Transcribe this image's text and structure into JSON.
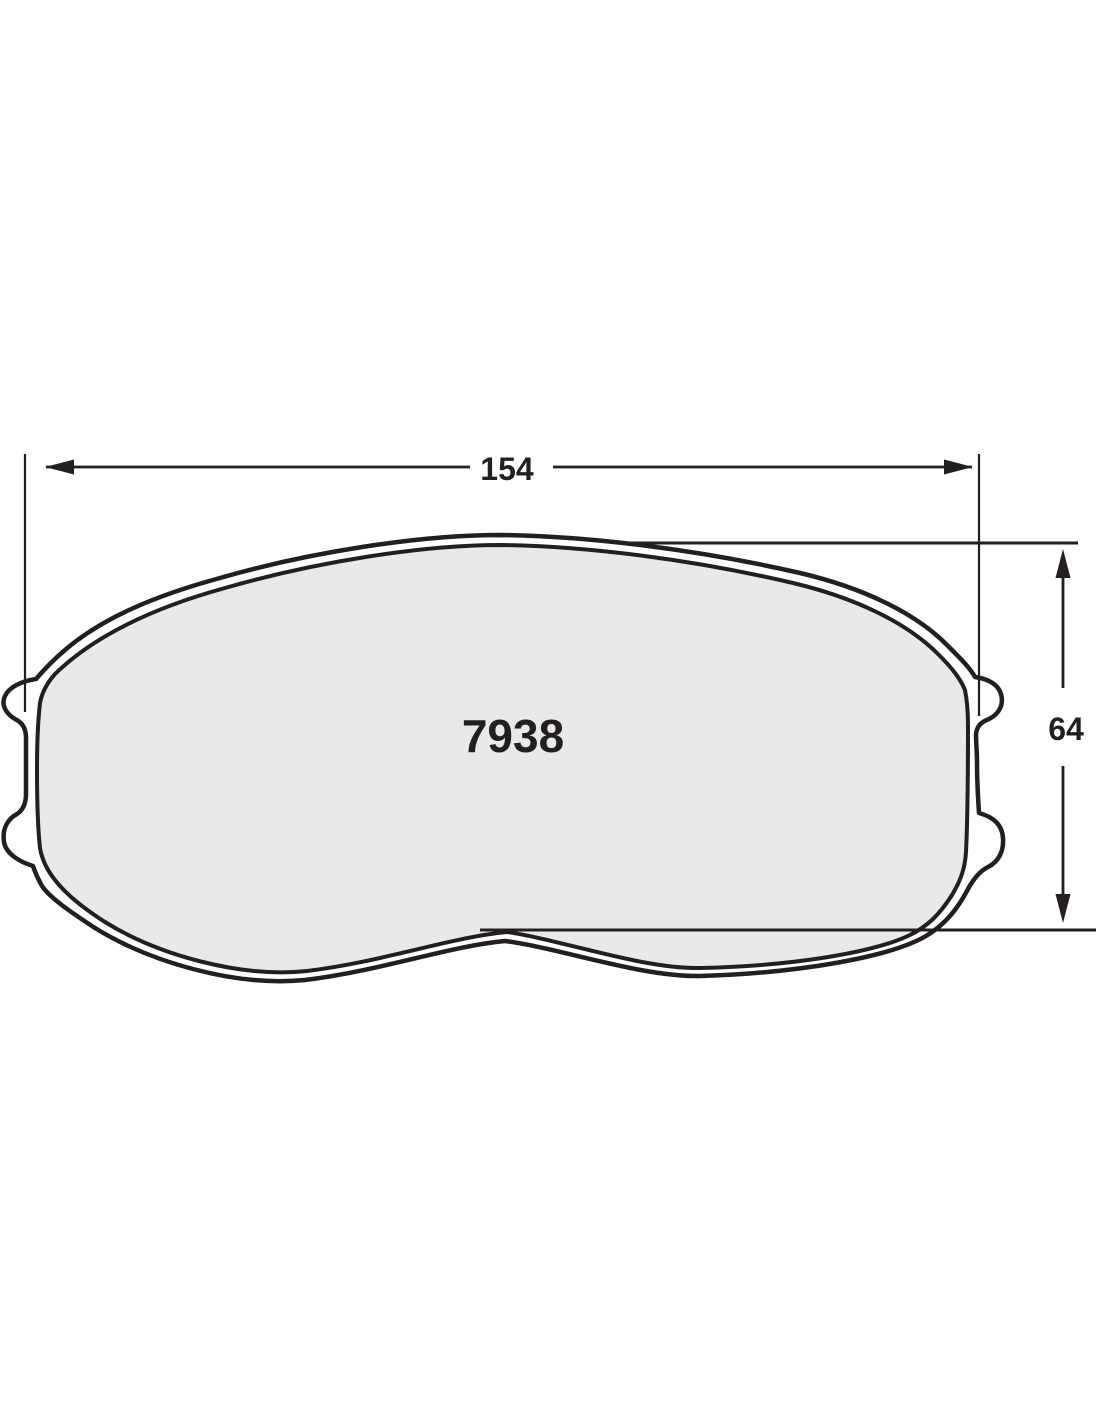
{
  "diagram": {
    "part_number": "7938",
    "width_dim": {
      "label": "154"
    },
    "height_dim": {
      "label": "64"
    },
    "colors": {
      "line": "#231f20",
      "pad_fill": "#e8e9ea",
      "backing_fill": "#ffffff",
      "background": "#ffffff"
    }
  }
}
